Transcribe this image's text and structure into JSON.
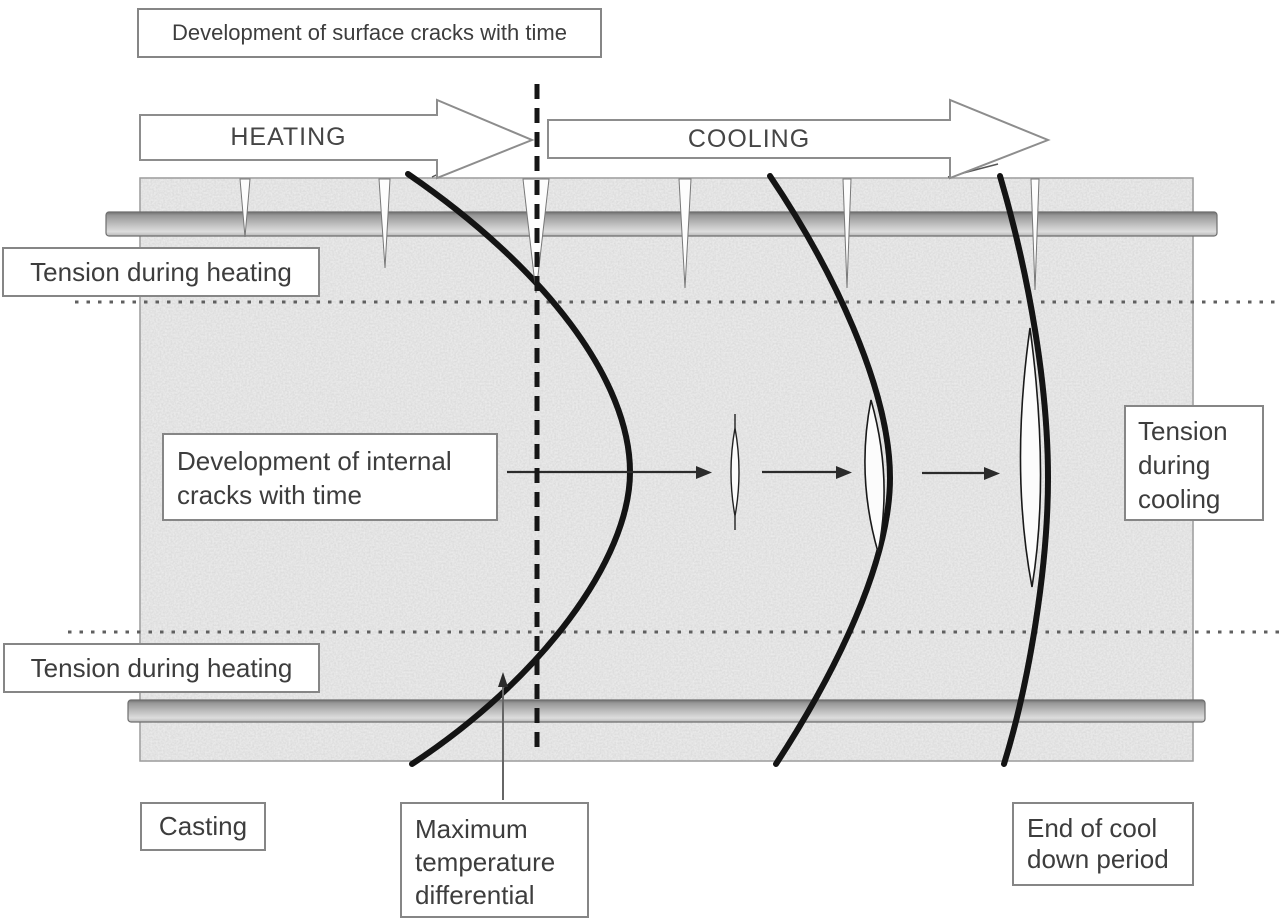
{
  "title": "Development of surface cracks with time",
  "arrows": {
    "heating": "HEATING",
    "cooling": "COOLING"
  },
  "labels": {
    "tension_heating_top": "Tension during heating",
    "tension_heating_bottom": "Tension during heating",
    "internal_cracks": "Development of internal cracks with time",
    "tension_cooling": "Tension during cooling",
    "casting": "Casting",
    "max_temp_differential": "Maximum temperature differential",
    "end_cooldown": "End of cool down period"
  },
  "colors": {
    "background": "#ffffff",
    "body_fill": "#ececec",
    "curve": "#141414",
    "box_border": "#868686",
    "text": "#3d3d3d",
    "rebar_mid": "#bdbdbd",
    "dashed_line": "#161616",
    "dotted_line": "#5f5f5f"
  }
}
